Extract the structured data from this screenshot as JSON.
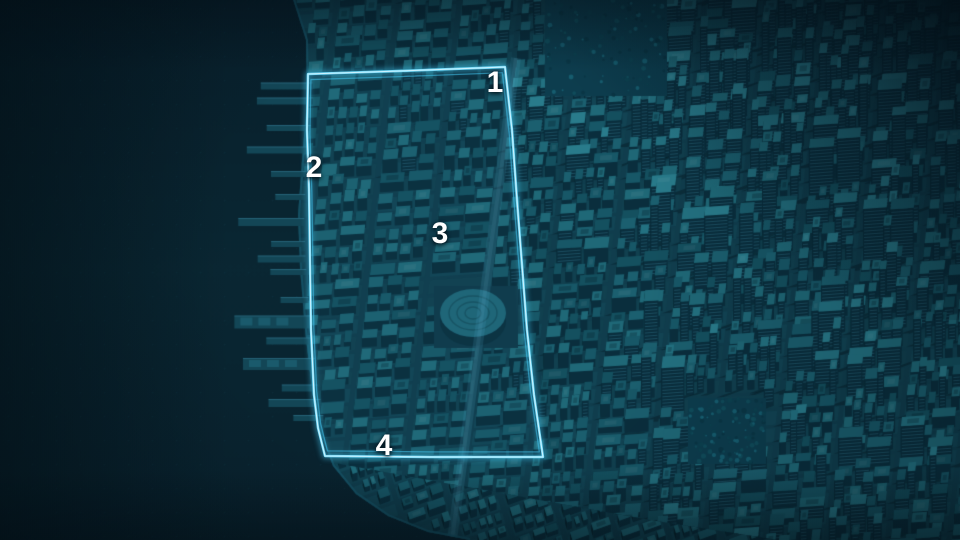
{
  "scene": {
    "kind": "3d-city-map",
    "city": "dense waterfront city grid"
  },
  "markers": [
    {
      "label": "1",
      "x": 495,
      "y": 83
    },
    {
      "label": "2",
      "x": 314,
      "y": 168
    },
    {
      "label": "3",
      "x": 440,
      "y": 234
    },
    {
      "label": "4",
      "x": 384,
      "y": 446
    }
  ],
  "highlight_region": {
    "outline_color": "#3fc0ea",
    "outline_main_color": "#72d9f8",
    "outline_core_color": "#ddf7ff",
    "fill_color": "rgba(110,215,250,0.045)",
    "points": [
      [
        308,
        74
      ],
      [
        400,
        71
      ],
      [
        505,
        67
      ],
      [
        512,
        130
      ],
      [
        517,
        200
      ],
      [
        522,
        265
      ],
      [
        527,
        330
      ],
      [
        534,
        395
      ],
      [
        543,
        457
      ],
      [
        430,
        457
      ],
      [
        325,
        456
      ],
      [
        318,
        428
      ],
      [
        314,
        395
      ],
      [
        311,
        330
      ],
      [
        310,
        260
      ],
      [
        309,
        190
      ],
      [
        307,
        130
      ]
    ]
  },
  "palette": {
    "water": "#0a2733",
    "water_deep": "#081f2b",
    "ground": "#103d4d",
    "block_a": "#11404f",
    "block_b": "#124454",
    "building_tops": [
      "#14505f",
      "#175767",
      "#1b5f6f",
      "#1f6877",
      "#237181",
      "#297b8b"
    ],
    "building_side": "#0a2e3d",
    "building_side_dark": "#07242f",
    "window_line": "rgba(62,140,165,0.35)",
    "shadow": "rgba(5,24,34,0.42)",
    "pier": "#134656",
    "pier_top": "#1a5a6c",
    "park_base": "#0d3d4e",
    "park_dots": [
      "#0a3443",
      "#12505f",
      "#196578",
      "#0c4251"
    ],
    "coast_road": "#17566a",
    "avenue_glow": "rgba(80,175,205,0.16)",
    "marker_text": "#ffffff"
  },
  "map": {
    "parks": [
      {
        "x": 545,
        "y": 0,
        "w": 122,
        "h": 96
      },
      {
        "x": 688,
        "y": 398,
        "w": 78,
        "h": 66
      }
    ],
    "stadium": {
      "cx": 473,
      "cy": 316,
      "rx": 33,
      "ry": 25,
      "plaza": [
        434,
        286,
        84,
        62
      ]
    },
    "piers": [
      [
        86,
        46,
        7
      ],
      [
        101,
        50,
        7
      ],
      [
        128,
        38,
        6
      ],
      [
        150,
        56,
        7
      ],
      [
        174,
        30,
        6
      ],
      [
        197,
        24,
        6
      ],
      [
        222,
        60,
        8
      ],
      [
        244,
        28,
        6
      ],
      [
        259,
        42,
        7
      ],
      [
        272,
        30,
        6
      ],
      [
        300,
        22,
        6
      ],
      [
        322,
        70,
        13
      ],
      [
        341,
        40,
        7
      ],
      [
        364,
        66,
        12
      ],
      [
        388,
        30,
        7
      ],
      [
        403,
        46,
        8
      ],
      [
        418,
        24,
        6
      ]
    ],
    "shoreline": [
      [
        290,
        -10
      ],
      [
        306,
        40
      ],
      [
        307,
        100
      ],
      [
        302,
        160
      ],
      [
        298,
        215
      ],
      [
        300,
        268
      ],
      [
        305,
        330
      ],
      [
        312,
        390
      ],
      [
        320,
        432
      ],
      [
        333,
        466
      ],
      [
        356,
        494
      ],
      [
        388,
        516
      ],
      [
        428,
        532
      ],
      [
        470,
        540
      ]
    ]
  }
}
